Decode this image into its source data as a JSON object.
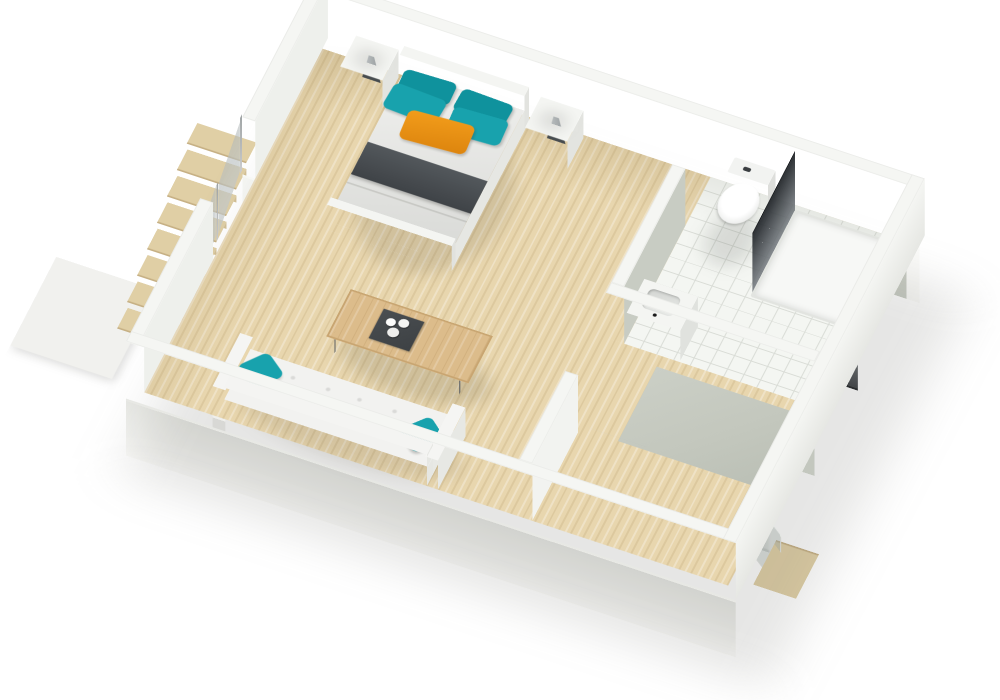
{
  "meta": {
    "type": "3d-floor-plan-render",
    "view": "tilted axonometric top-down view of a studio apartment, rotated clockwise",
    "background": "white with soft drop shadow to the lower right"
  },
  "colors": {
    "floorWood": "#e8d6ae",
    "floorWoodStreak": "#d9c294",
    "wallTop": "#f5f6f3",
    "wallBright": "#fbfbf9",
    "wallInner": "#eef0ec",
    "bathWall": "#c8ccc3",
    "bathWallLight": "#d6dad1",
    "tile": "#f4f6f2",
    "tileLine": "#d9dcd6",
    "grayFloor": "#c3c7bd",
    "teal": "#18a2ad",
    "tealDark": "#0f929d",
    "orange": "#f39d1b",
    "throwDark": "#3f4347",
    "tableWood": "#dcbc8b",
    "tableEdge": "#c8a571",
    "legDark": "#5b5f62",
    "trayDark": "#3d4144",
    "doorGray1": "#c2c6c9",
    "doorGray2": "#969ba0",
    "glassFrame": "#bcc0c1",
    "showerDark": "#2b2f33",
    "showerLight": "#7e8489",
    "vaseLight": "#c6cacb",
    "vaseDark": "#8f9597",
    "stairWood": "#e0cfa5",
    "stairEdge": "#c6b084",
    "landing": "#f1f1ee",
    "shadow": "rgba(100,102,96,0.16)"
  },
  "rooms": [
    {
      "name": "main-room",
      "floor": "light wood planks",
      "contents": [
        "double-bed",
        "nightstand-left",
        "nightstand-right",
        "sofa",
        "coffee-table"
      ]
    },
    {
      "name": "bathroom",
      "floor": "white tile grid",
      "walls": "gray-green",
      "contents": [
        "toilet",
        "shower-dark-glass",
        "sink-counter"
      ]
    },
    {
      "name": "hallway-closet",
      "floor": "light wood with gray closet zone",
      "contents": [
        "glass-partition",
        "sliding-door-1",
        "sliding-door-2",
        "corner-glass-panel"
      ]
    }
  ],
  "furniture": {
    "bed": {
      "frame": "white",
      "duvet": "white-gray",
      "throw": "dark gray band",
      "pillows": {
        "teal": 4,
        "orange": 1
      }
    },
    "nightstands": {
      "count": 2,
      "color": "white",
      "decor": "gray cone vase"
    },
    "sofa": {
      "seats": 3,
      "color": "white tufted",
      "pillows": {
        "teal": 2
      }
    },
    "coffee_table": {
      "top": "light wood",
      "legs": "thin dark metal",
      "tray": "dark square tray with white cups"
    }
  },
  "fixtures": {
    "toilet": "white, tank with dark flush button",
    "shower": "two smoked dark glass panels over white tray",
    "sink": "white counter with recessed basin and black faucet dot"
  },
  "stairs": {
    "location": "through opening in left wall, descending outside",
    "treads": 8,
    "railing": {
      "glass_panels": 2,
      "posts": 3,
      "frame": "aluminum"
    },
    "landing": "white platform at bottom"
  },
  "doors": {
    "sliding_gray_panels": 2,
    "handle": "small square"
  }
}
